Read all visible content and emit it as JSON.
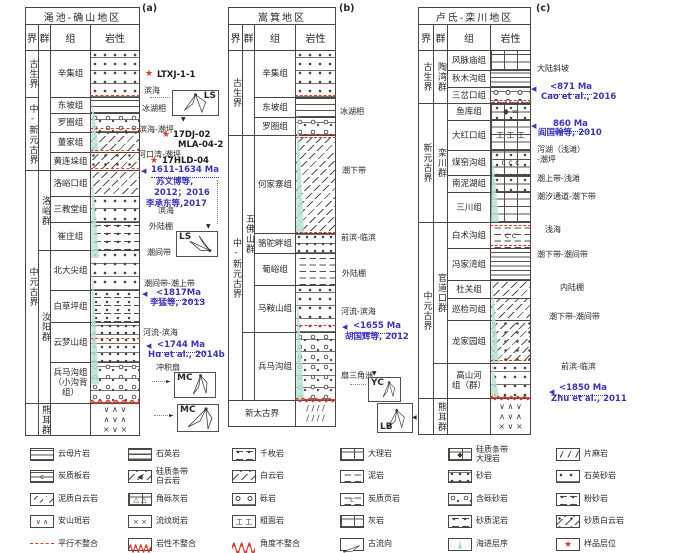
{
  "th": {
    "era": "界",
    "group": "群",
    "fm": "组",
    "lith": "岩性"
  },
  "icons": {
    "star": "★",
    "arrow_left": "◀",
    "arrow_down": "▼",
    "arrow_right": "►"
  },
  "patterns": {
    "volcanic": "∨   ∧   ∨\n∧   ∨   ∧\n×   ∨   ×",
    "gneiss": "/  /  /  /\n/  /  /  /"
  },
  "sections": [
    {
      "panel": "(a)",
      "title": "渑池-确山地区",
      "eras": [
        "古生界",
        "中-新元古界",
        "中元古界"
      ],
      "groups": [
        "洛峪群",
        "汝阳群",
        "熊耳群"
      ],
      "formations": [
        {
          "n": "辛集组"
        },
        {
          "n": "东坡组"
        },
        {
          "n": "罗圈组"
        },
        {
          "n": "董家组"
        },
        {
          "n": "黄连垛组"
        },
        {
          "n": "洛峪口组"
        },
        {
          "n": "三教堂组"
        },
        {
          "n": "崔庄组"
        },
        {
          "n": "北大尖组"
        },
        {
          "n": "白草坪组"
        },
        {
          "n": "云梦山组"
        },
        {
          "n": "兵马沟组\n（小沟背组）"
        }
      ],
      "facies": [
        "滨海",
        "冰湖相",
        "滨海-潮坪",
        "河口湾-潮坪",
        "滨海",
        "外陆棚",
        "潮间带",
        "潮间带-潮上带",
        "河流-滨海",
        "冲积扇"
      ],
      "samples": [
        "LTXJ-1-1",
        "17DJ-02",
        "MLA-04-2",
        "17HLD-04"
      ],
      "ages": [
        "1611-1634 Ma",
        "<1817Ma",
        "<1744 Ma"
      ],
      "refs": [
        "苏文博等,",
        "2012；2016",
        "李承东等,2017",
        "李猛等, 2013",
        "Hu et al., 2014b"
      ],
      "roses": [
        "LS",
        "LS",
        "MC",
        "MC"
      ]
    },
    {
      "panel": "(b)",
      "title": "嵩箕地区",
      "eras": [
        "古生界",
        "中-新元古界"
      ],
      "groups": [
        "五佛山群"
      ],
      "basement": "新太古界",
      "formations": [
        {
          "n": "辛集组"
        },
        {
          "n": "东坡组"
        },
        {
          "n": "罗圈组"
        },
        {
          "n": "何家寨组"
        },
        {
          "n": "骆驼畔组"
        },
        {
          "n": "葡峪组"
        },
        {
          "n": "马鞍山组"
        },
        {
          "n": "兵马沟组"
        }
      ],
      "facies": [
        "冰湖相",
        "潮下带",
        "前滨-临滨",
        "外陆棚",
        "河流-滨海",
        "扇三角洲"
      ],
      "ages": [
        "<1655 Ma"
      ],
      "refs": [
        "胡国辉等, 2012"
      ],
      "roses": [
        "YC",
        "LB"
      ]
    },
    {
      "panel": "(c)",
      "title": "卢氏-栾川地区",
      "eras": [
        "古生界",
        "新元古界",
        "中元古界"
      ],
      "groups": [
        "陶湾群",
        "栾川群",
        "官道口群",
        "熊耳群"
      ],
      "formations": [
        {
          "n": "风脉庙组"
        },
        {
          "n": "秋木沟组"
        },
        {
          "n": "三岔口组"
        },
        {
          "n": "鱼库组",
          "g": "◆   ∞"
        },
        {
          "n": "大红口组",
          "g": "工 工 工"
        },
        {
          "n": "煤窑沟组",
          "g": "c   c   c"
        },
        {
          "n": "南泥湖组"
        },
        {
          "n": "三川组"
        },
        {
          "n": "白术沟组",
          "g": "c      c"
        },
        {
          "n": "冯家湾组"
        },
        {
          "n": "杜关组"
        },
        {
          "n": "巡检司组"
        },
        {
          "n": "龙家园组"
        },
        {
          "n": "高山河\n组（群）"
        }
      ],
      "facies": [
        "大陆斜坡",
        "泻湖（浅滩）\n-潮坪",
        "潮上带-浅滩",
        "潮汐通道-潮下带",
        "浅海",
        "潮下带-潮间带",
        "内陆棚",
        "潮下带-潮间带",
        "前滨-临滨"
      ],
      "ages": [
        "<871 Ma",
        "860 Ma",
        "<1850 Ma"
      ],
      "refs": [
        "Cao et al., 2016",
        "阎国翰等, 2010",
        "Zhu et al., 2011"
      ]
    }
  ],
  "legend": {
    "items": [
      {
        "label": "云母片岩"
      },
      {
        "label": "石英岩"
      },
      {
        "label": "千枚岩"
      },
      {
        "label": "大理岩"
      },
      {
        "label": "硅质条带\n大理岩",
        "g": "◆"
      },
      {
        "label": "片麻岩"
      },
      {
        "label": "炭质板岩",
        "g": "c"
      },
      {
        "label": "硅质条带\n白云岩",
        "g": "◀"
      },
      {
        "label": "白云岩"
      },
      {
        "label": "泥岩"
      },
      {
        "label": "砂岩"
      },
      {
        "label": "石英砂岩"
      },
      {
        "label": "泥质白云岩"
      },
      {
        "label": "角砾灰岩",
        "g": "△ △"
      },
      {
        "label": "砾岩"
      },
      {
        "label": "炭质页岩",
        "g": "c"
      },
      {
        "label": "含砾砂岩"
      },
      {
        "label": "粉砂岩"
      },
      {
        "label": "安山斑岩",
        "g": "∨ ∧"
      },
      {
        "label": "流纹斑岩",
        "g": "× ×"
      },
      {
        "label": "粗面岩",
        "g": "工 工"
      },
      {
        "label": "灰岩"
      },
      {
        "label": "砂质泥岩"
      },
      {
        "label": "砂质白云岩"
      },
      {
        "label": "平行不整合"
      },
      {
        "label": "岩性不整合"
      },
      {
        "label": "角度不整合"
      },
      {
        "label": "古流向"
      },
      {
        "label": "海进层序"
      },
      {
        "label": "样品层位",
        "g": "★"
      }
    ]
  }
}
